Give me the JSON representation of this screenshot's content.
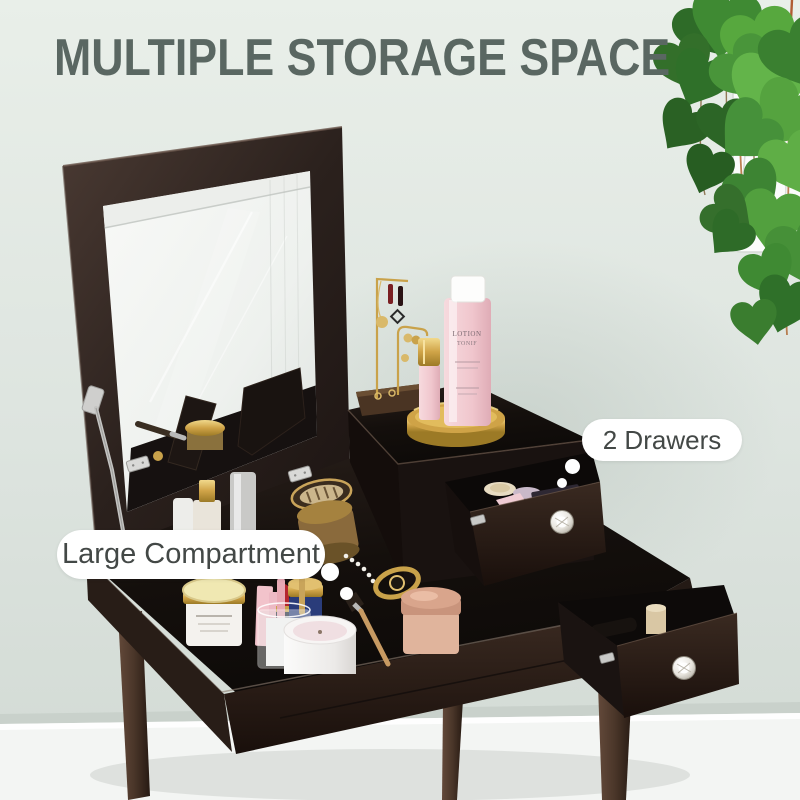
{
  "title": {
    "text": "MULTIPLE STORAGE SPACE"
  },
  "callouts": {
    "drawers": {
      "text": "2 Drawers"
    },
    "compartment": {
      "text": "Large Compartment"
    }
  },
  "product_details": {
    "bottle_label_line1": "LOTION",
    "bottle_label_line2": "TONIF"
  },
  "colors": {
    "wall": "#e2e9e4",
    "wainscot": "#f3f5f3",
    "title-color": "#5a6762",
    "label-text": "#434846",
    "label-bg": "#ffffff",
    "wood-dark": "#1a1310",
    "wood-mid": "#33261e",
    "leg-brown": "#4e3a2d",
    "gold": "#c9a24a",
    "leaf-green": "#46913a",
    "knob-crystal": "#f2f1ed",
    "bottle-pink": "#f2cdd3"
  }
}
